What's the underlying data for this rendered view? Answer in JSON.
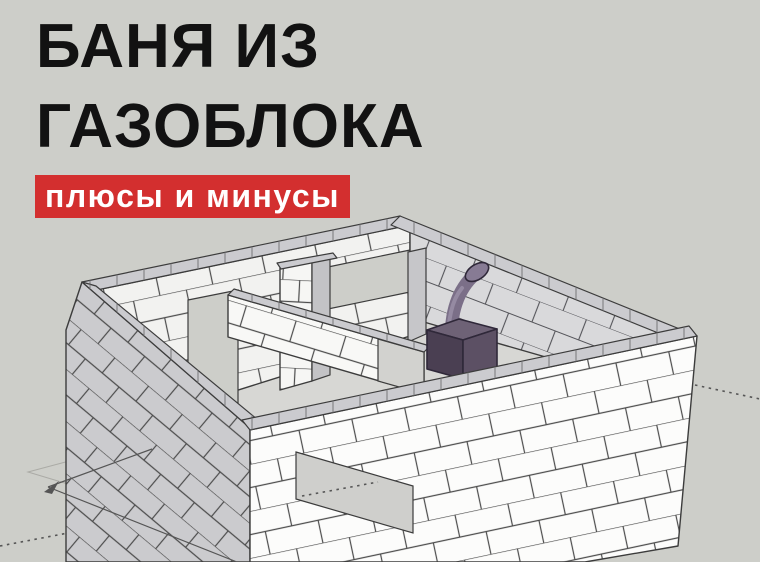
{
  "header": {
    "title_line1": "БАНЯ ИЗ",
    "title_line2": "ГАЗОБЛОКА",
    "badge": "плюсы и минусы"
  },
  "illustration": {
    "label": "3D SketchUp-style model of a roofless aerated-concrete block bathhouse with interior partition walls, doorway and window openings, a purple sauna stove with a curved chimney pipe, plus dimension arrows and dotted guide lines"
  },
  "colors": {
    "bg": "#cdcec9",
    "ink": "#121212",
    "badge-bg": "#d32f2f",
    "badge-text": "#ffffff",
    "face-white": "#fcfcfb",
    "face-nw": "#f2f2f0",
    "face-ne": "#d9d9db",
    "face-sw": "#cbcbce",
    "joint": "#4c4c4c",
    "cap": "#cbcbcf",
    "cap-tick": "#77777a",
    "floor": "#d7d7d4",
    "outline": "#3c3c3c",
    "stove-front": "#4a3f52",
    "stove-side": "#5c5064",
    "stove-top": "#6e6276",
    "pipe": "#7b6f88",
    "pipe-dark": "#2f2839",
    "guide": "#565656"
  }
}
